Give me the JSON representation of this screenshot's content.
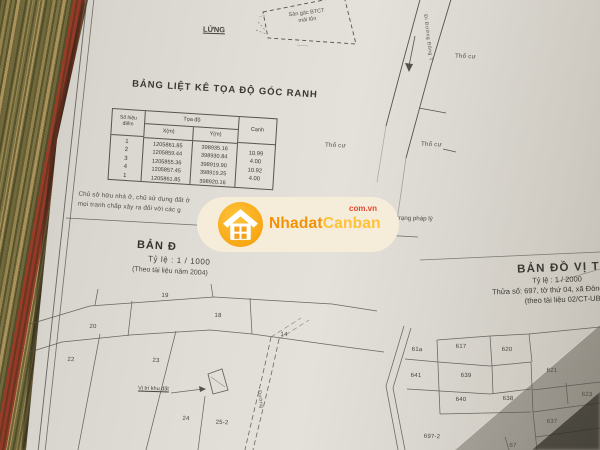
{
  "top_diagram": {
    "lung_label": "LỬNG",
    "structure_line1": "Sàn gác BTCT",
    "structure_line2": "mái tôn"
  },
  "road": {
    "label": "Đi Đường Đông T"
  },
  "zoning_labels": {
    "a": "Thổ cư",
    "b": "Thổ cư",
    "c": "Thổ cư"
  },
  "coordinate_table": {
    "title": "BẢNG LIỆT KÊ TỌA ĐỘ GÓC RANH",
    "col_point_line1": "Số hiệu",
    "col_point_line2": "điểm",
    "col_toado": "Tọa độ",
    "col_x": "X(m)",
    "col_y": "Y(m)",
    "col_canh": "Cạnh",
    "points": [
      "1",
      "2",
      "3",
      "4",
      "1"
    ],
    "x_values": [
      "1205861.85",
      "1205859.44",
      "1205855.36",
      "1205857.45",
      "1205861.85"
    ],
    "y_values": [
      "398935.16",
      "398930.84",
      "398919.90",
      "398919.25",
      "398920.16"
    ],
    "canh_values": [
      "10.99",
      "4.00",
      "10.92",
      "4.00"
    ]
  },
  "notes": {
    "line1": "Chủ sở hữu nhà ở, chủ sử dụng đất ở",
    "line2": "mọi tranh chấp xảy ra đối với các g",
    "fragment_right": "tình trạng pháp lý"
  },
  "watermark": {
    "brand_first": "Nhadat",
    "brand_second": "Canban",
    "domain": "com.vn",
    "color_orange": "#f49205",
    "color_yellow": "#ffc235",
    "color_red": "#e0492f",
    "color_bg": "#f6ecda"
  },
  "map_left": {
    "title_partial": "BẢN Đ",
    "scale": "Tỷ lệ :  1 / 1000",
    "source": "(Theo tài liệu năm 2004)",
    "plots": [
      "19",
      "18",
      "14",
      "20",
      "22",
      "23",
      "24",
      "25-2"
    ],
    "marker_label": "Vị trí khu đất",
    "road_label": "Đường"
  },
  "map_right": {
    "title_partial": "BẢN ĐỒ VỊ TR",
    "scale": "Tỷ lệ :  1 / 2000",
    "parcel_line": "Thửa số: 697, tờ thứ 04, xã Đông T",
    "source_line": "(theo tài liệu 02/CT-UB",
    "plots": [
      "61a",
      "617",
      "620",
      "641",
      "639",
      "621",
      "640",
      "638",
      "623",
      "637",
      "697-2",
      "67"
    ]
  }
}
